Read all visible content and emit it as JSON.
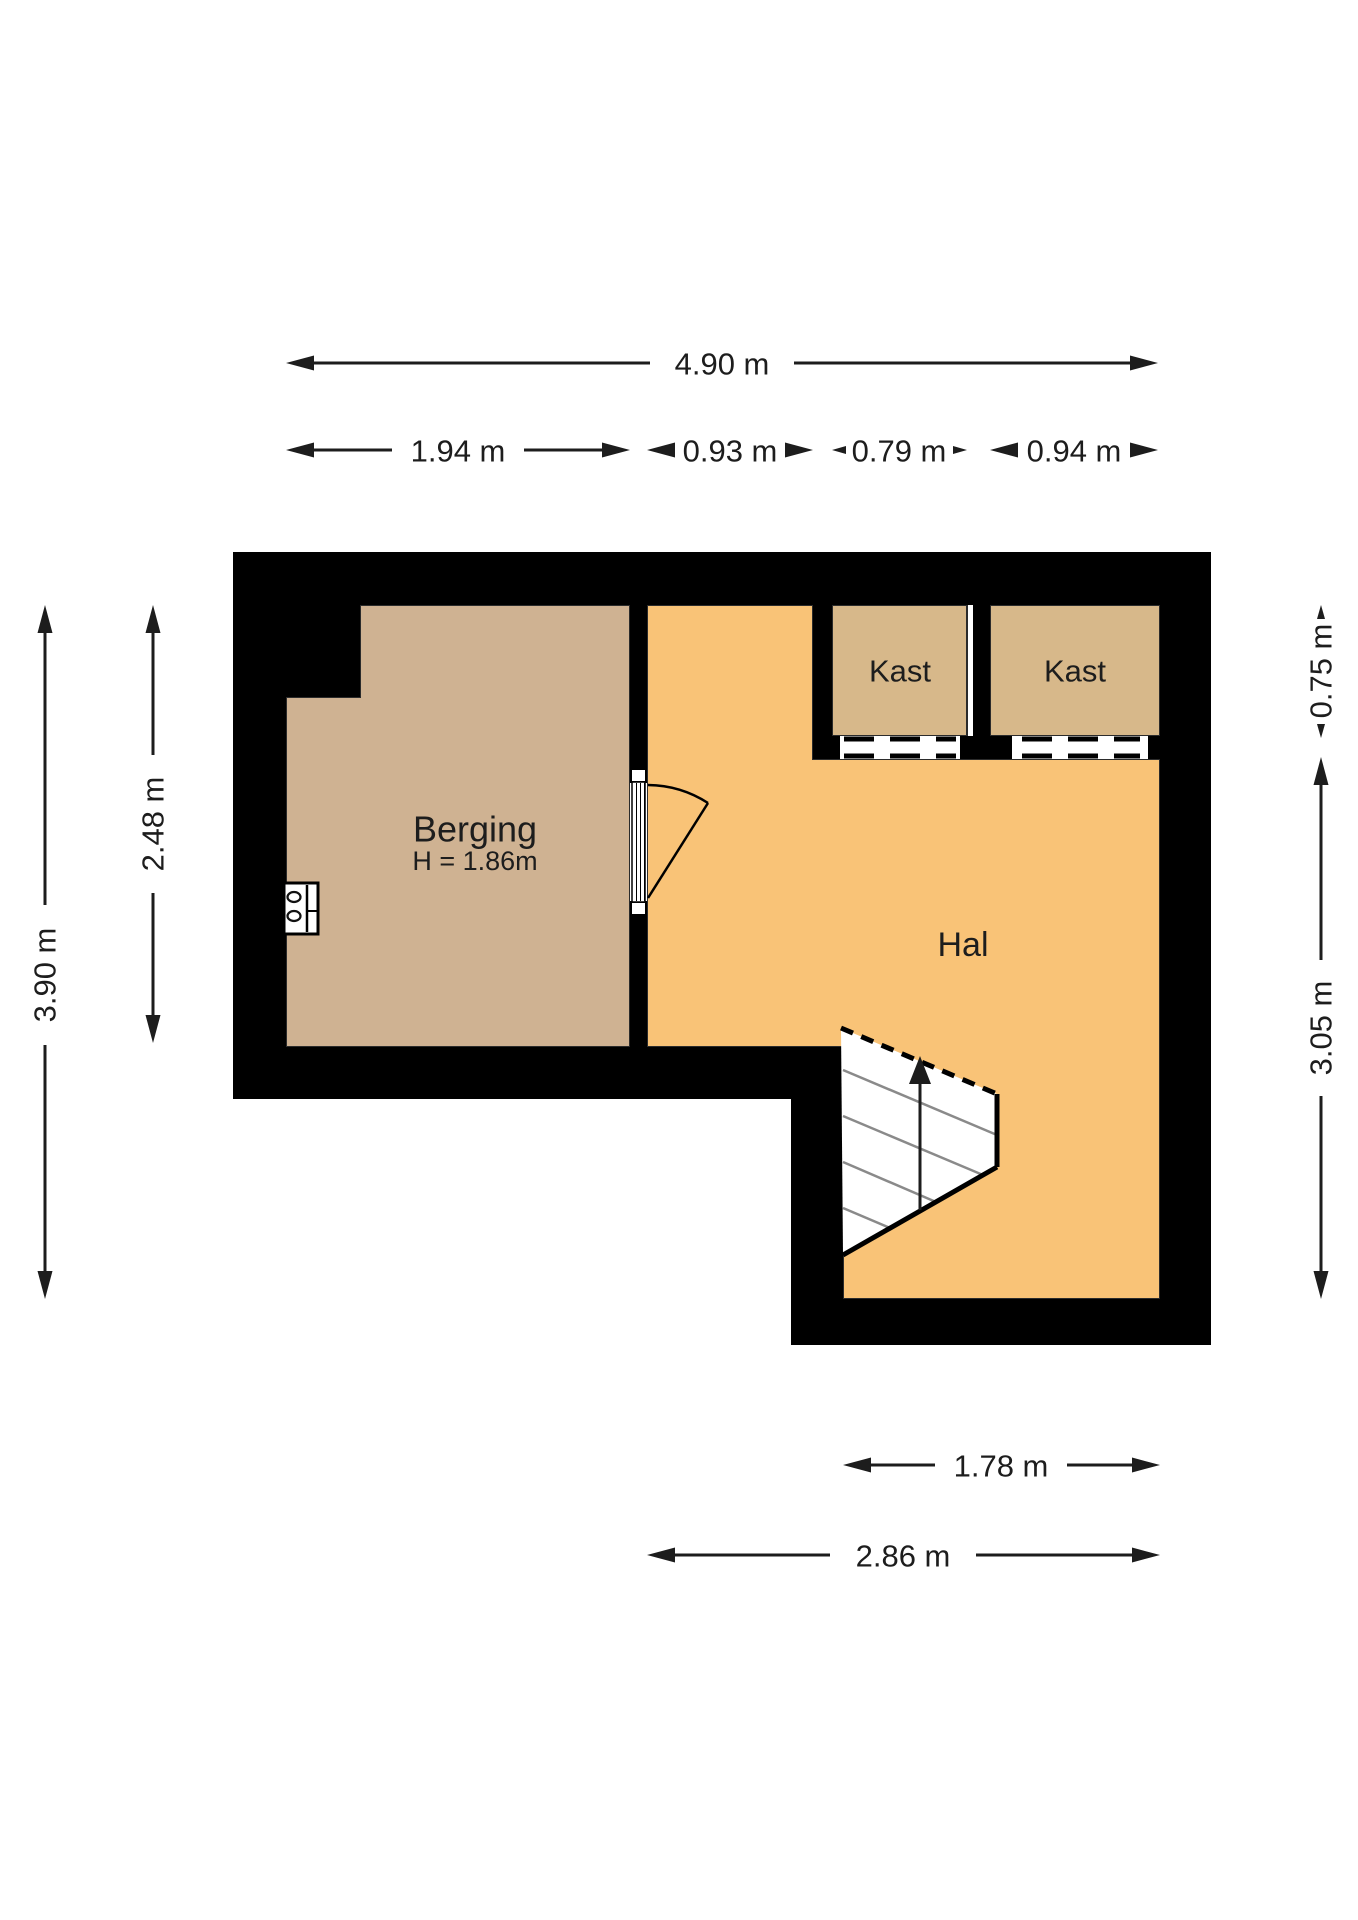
{
  "floorplan": {
    "rooms": {
      "berging": {
        "label": "Berging",
        "height_note": "H = 1.86m"
      },
      "hal": {
        "label": "Hal"
      },
      "kast1": {
        "label": "Kast"
      },
      "kast2": {
        "label": "Kast"
      }
    },
    "dimensions": {
      "top_total": "4.90 m",
      "berging_width": "1.94 m",
      "hal_top_width": "0.93 m",
      "kast1_width": "0.79 m",
      "kast2_width": "0.94 m",
      "left_total_height": "3.90 m",
      "berging_height": "2.48 m",
      "kast_depth": "0.75 m",
      "hal_height": "3.05 m",
      "stairs_width": "1.78 m",
      "hal_width": "2.86 m"
    },
    "colors": {
      "wall": "#000000",
      "berging_floor": "#cfb292",
      "hal_floor": "#f9c377",
      "kast_floor": "#d7b88a",
      "background": "#ffffff"
    }
  }
}
